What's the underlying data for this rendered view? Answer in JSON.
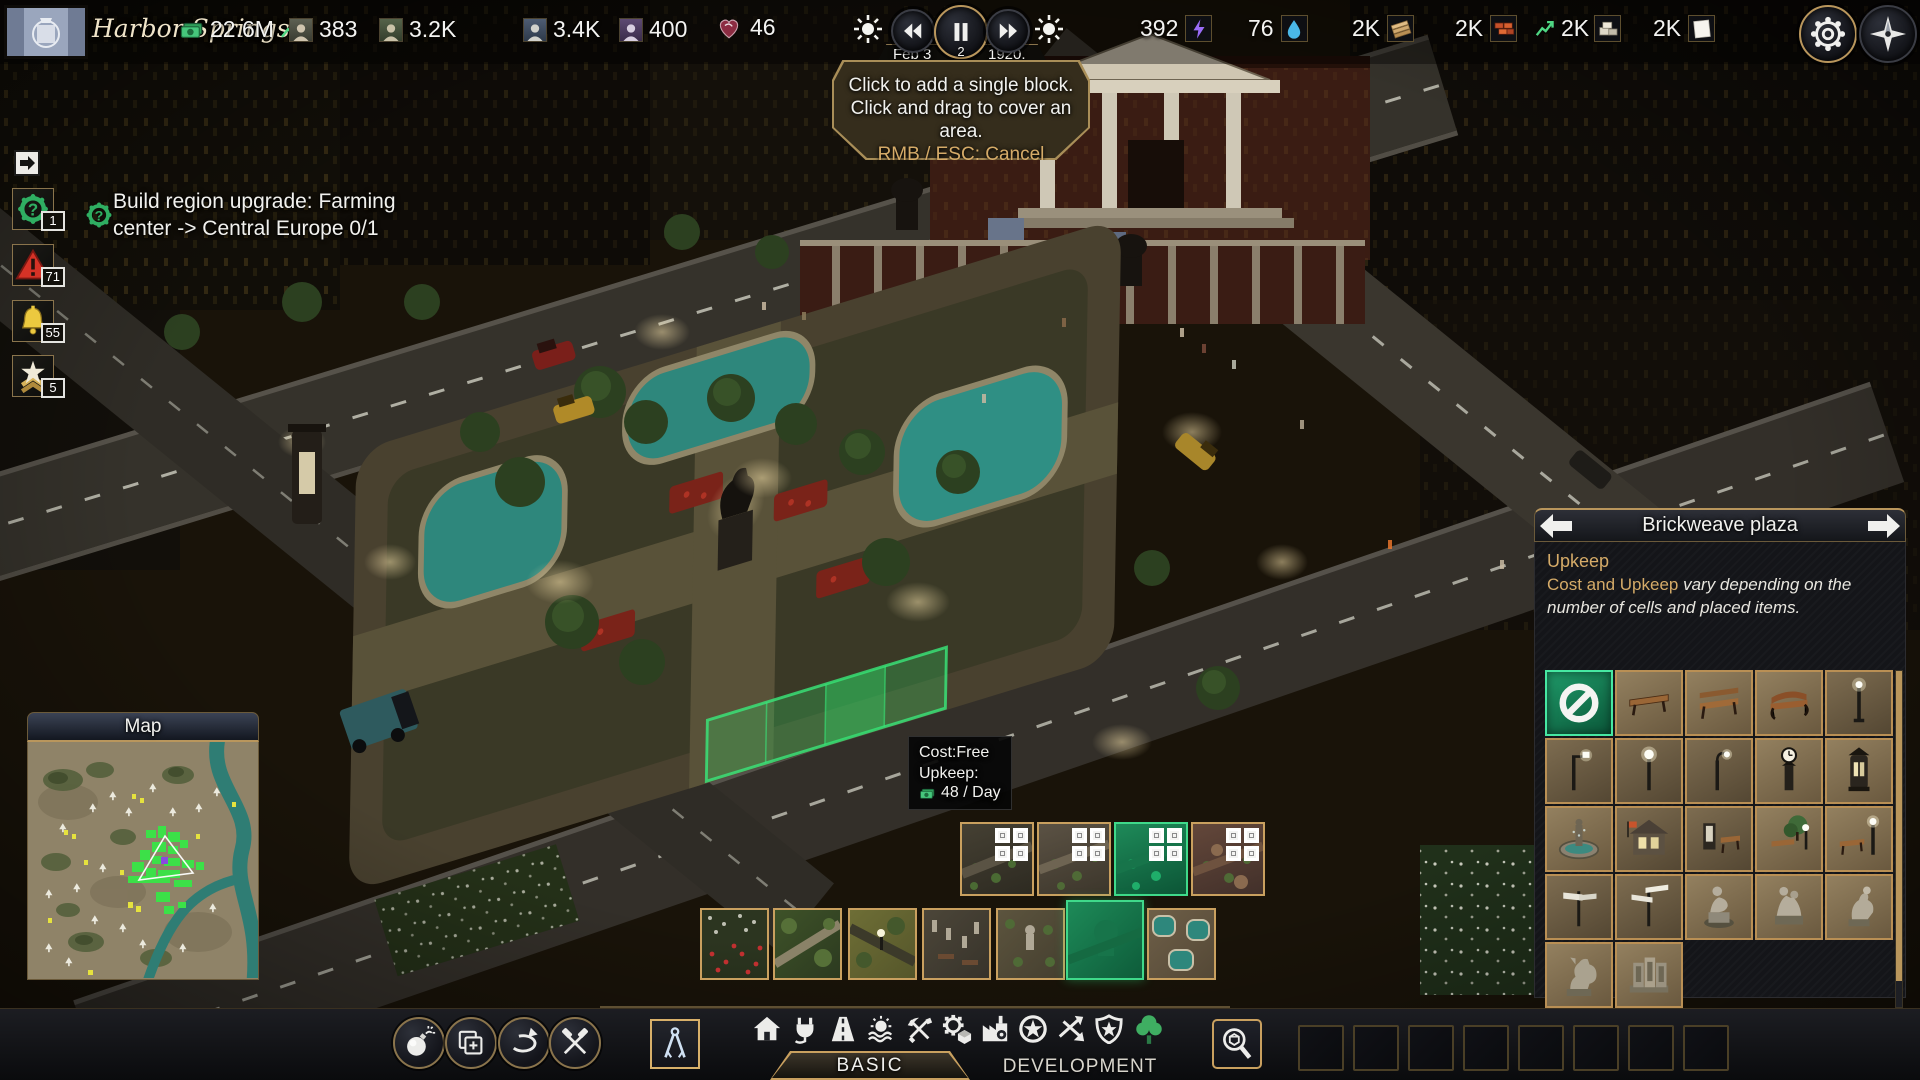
{
  "colors": {
    "accent_gold": "#c9a05f",
    "accent_green": "#2fae62",
    "selection_green": "#46e8a2",
    "warning_red": "#d63226",
    "bell_yellow": "#ecc93f"
  },
  "top_bar": {
    "city_name": "Harbor Springs",
    "money": {
      "value": "22.6M",
      "trend": "up"
    },
    "population": [
      {
        "value": "383"
      },
      {
        "value": "3.2K"
      },
      {
        "value": "3.4K"
      },
      {
        "value": "400"
      }
    ],
    "approval": {
      "value": "46"
    },
    "time": {
      "date": "Feb 3",
      "speed": "2",
      "year": "1920."
    },
    "power": {
      "value": "392"
    },
    "water": {
      "value": "76"
    },
    "planks": {
      "value": "2K"
    },
    "bricks": {
      "value": "2K"
    },
    "stone": {
      "value": "2K",
      "trend": "up"
    },
    "paper": {
      "value": "2K"
    }
  },
  "hint": {
    "line1": "Click to add a single block.",
    "line2": "Click and drag to cover an area.",
    "line3": "RMB / ESC: Cancel"
  },
  "alerts": {
    "quests": "1",
    "warnings": "71",
    "notifications": "55",
    "rank": "5"
  },
  "objective": {
    "text": "Build region upgrade: Farming center -> Central Europe 0/1"
  },
  "map": {
    "title": "Map"
  },
  "tooltip": {
    "cost": "Cost:Free",
    "upkeep_label": "Upkeep:",
    "upkeep_value": "48 / Day"
  },
  "plaza_panel": {
    "title": "Brickweave plaza",
    "heading": "Upkeep",
    "desc_bold": "Cost and Upkeep",
    "desc_italic": " vary depending on the number of cells and placed items.",
    "items": [
      "remove-item",
      "bench-simple",
      "bench-backed",
      "bench-ornate",
      "street-lamp-tall",
      "street-lamp-arm",
      "street-lamp-round",
      "street-lamp-curved",
      "street-clock",
      "advertising-column",
      "fountain-small",
      "kiosk",
      "transit-shelter",
      "bench-with-tree",
      "bench-with-lamp",
      "signpost-double",
      "signpost-cross",
      "statue-seated",
      "statue-group",
      "statue-rearing",
      "statue-equestrian",
      "memorial-wall"
    ]
  },
  "toolbar": {
    "tabs": [
      {
        "label": "BASIC",
        "active": true
      },
      {
        "label": "DEVELOPMENT",
        "active": false
      }
    ],
    "tools": [
      "demolish",
      "clone",
      "relocate",
      "repair",
      "blueprint"
    ],
    "categories": [
      "residential",
      "power",
      "roads",
      "leisure",
      "resources",
      "production",
      "industry",
      "services",
      "logistics",
      "safety",
      "parks"
    ],
    "empty_slots": 8
  }
}
